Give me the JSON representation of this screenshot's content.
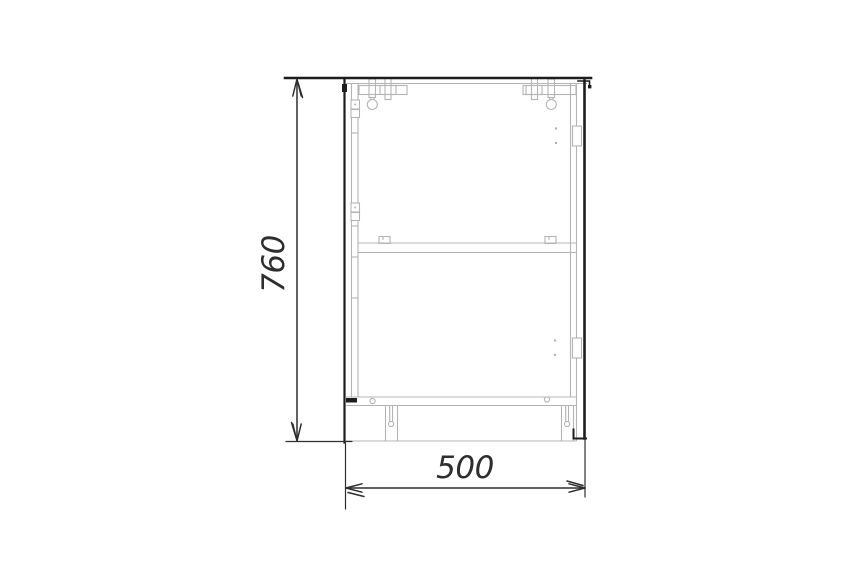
{
  "drawing": {
    "background_color": "#ffffff",
    "outline_color": "#1d1d1d",
    "detail_color": "#b4b4b4",
    "dimension_color": "#2e2e2e",
    "labels": {
      "height": "760",
      "width": "500"
    }
  }
}
